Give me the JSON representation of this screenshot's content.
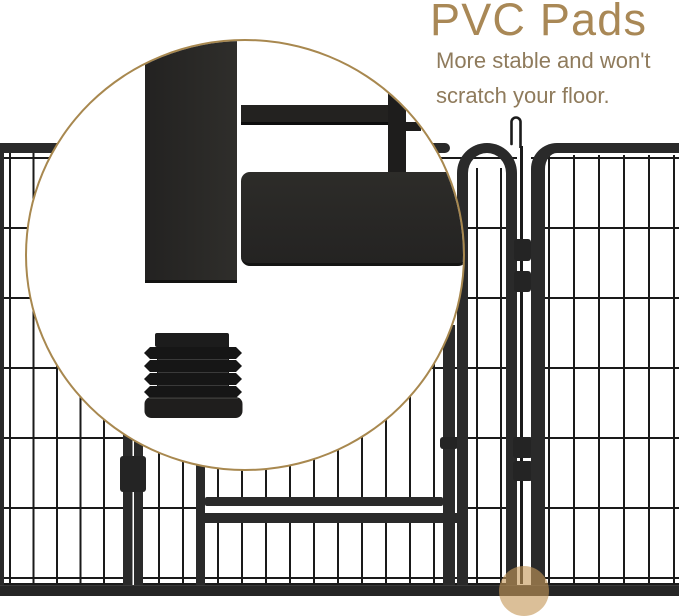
{
  "annotation": {
    "heading": "PVC Pads",
    "subtitle_line1": "More stable and won't",
    "subtitle_line2": "scratch your floor."
  },
  "colors": {
    "heading-tan": "#a98856",
    "subtitle-tan": "#8f7b5c",
    "callout-border": "#a8884f",
    "tube-dark": "#2a2a2a",
    "frame-black": "#262626",
    "wire-dark": "#1a1a1a",
    "pad-black": "#1b1b1b",
    "highlight-dot": "rgba(197, 152, 88, 0.62)",
    "background": "#ffffff"
  }
}
